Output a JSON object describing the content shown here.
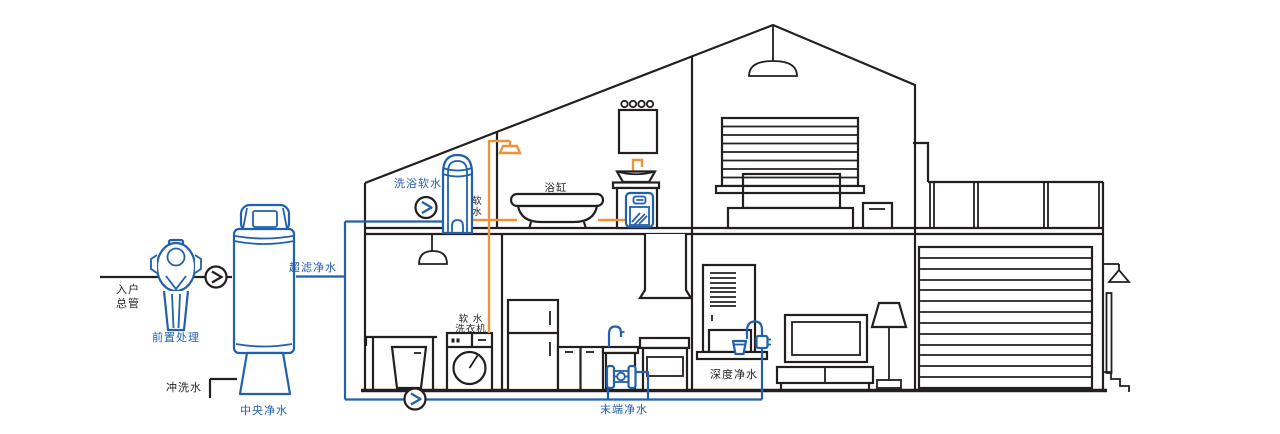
{
  "diagram": {
    "labels": {
      "inlet_line1": "入户",
      "inlet_line2": "总管",
      "prefilter": "前置处理",
      "flush_water": "冲洗水",
      "central_purifier": "中央净水",
      "ultrafiltration": "超滤净水",
      "bath_softener": "洗浴软水",
      "soft_water_char1": "软",
      "soft_water_char2": "水",
      "bathtub": "浴缸",
      "washer_line1": "软 水",
      "washer_line2": "洗衣机",
      "terminal_purifier": "末端净水",
      "deep_purifier": "深度净水"
    },
    "colors": {
      "blue": "#2160AC",
      "orange": "#EE9338",
      "ink": "#231F20"
    }
  }
}
